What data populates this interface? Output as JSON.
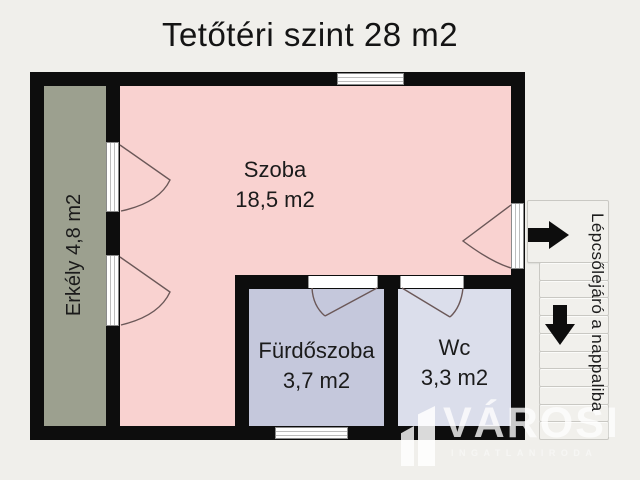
{
  "title": "Tetőtéri szint 28 m2",
  "rooms": {
    "balcony": {
      "label": "Erkély 4,8 m2"
    },
    "main": {
      "name": "Szoba",
      "area": "18,5 m2"
    },
    "bathroom": {
      "name": "Fürdőszoba",
      "area": "3,7 m2"
    },
    "wc": {
      "name": "Wc",
      "area": "3,3 m2"
    }
  },
  "stairs": {
    "label": "Lépcsőlejáró a nappaliba",
    "treads": 10
  },
  "watermark": {
    "brand": "VÁROSI",
    "subtitle": "INGATLANIRODA"
  },
  "colors": {
    "background": "#f0efeb",
    "wall": "#0d0d0d",
    "balcony_fill": "#9ca08f",
    "room_fill": "#f9d2d0",
    "bathroom_fill": "#c5c8dc",
    "wc_fill": "#dbdeeb",
    "stair_fill": "#f1f0ec",
    "stair_border": "#c9c8c3",
    "door_arc": "#6b5858",
    "watermark": "#ffffff"
  }
}
